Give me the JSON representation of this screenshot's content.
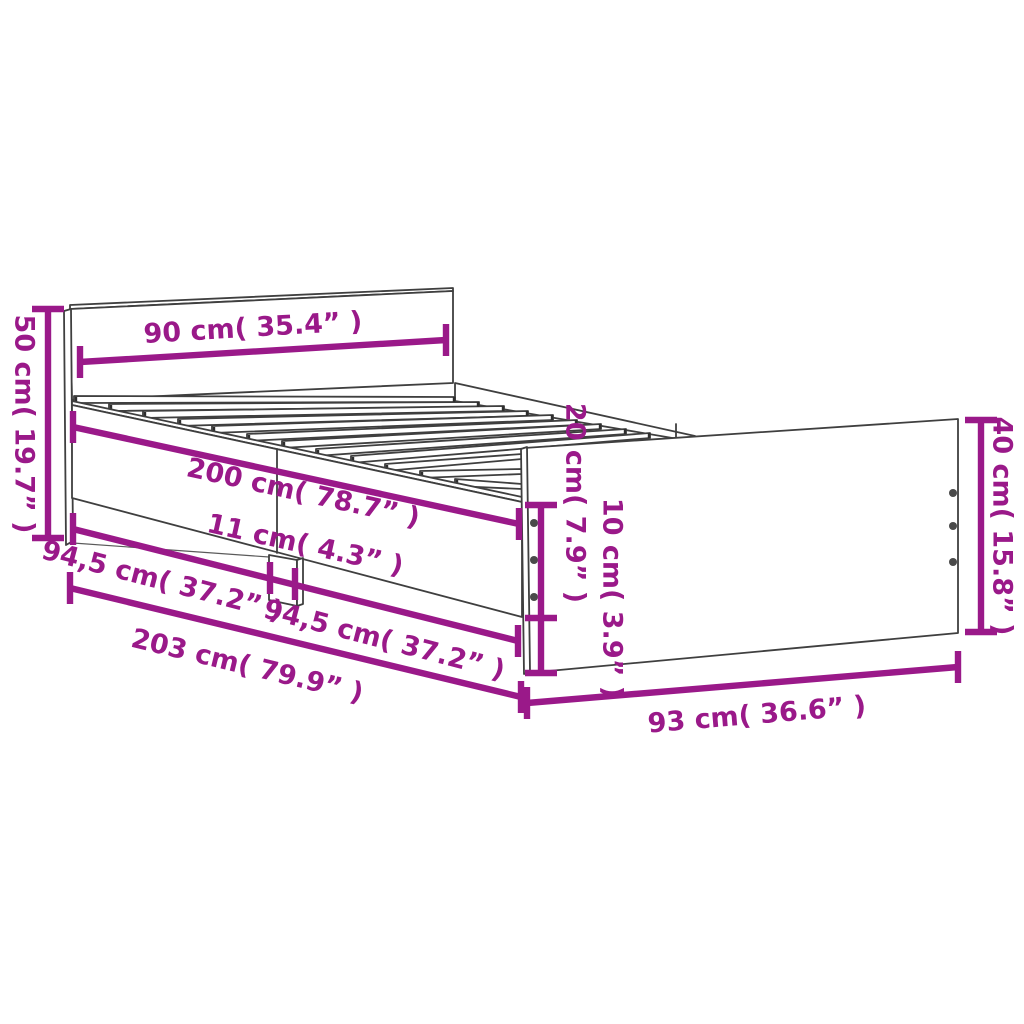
{
  "drawing": {
    "subject": "bed-frame-with-drawers-dimension-diagram",
    "accent_color": "#9A1989",
    "outline_color": "#3f3f3f",
    "slat_count": 12,
    "screw_dots_per_edge": 3
  },
  "dimensions": {
    "headboard_width": "90 cm( 35.4” )",
    "headboard_height": "50 cm( 19.7” )",
    "bed_length": "200 cm( 78.7” )",
    "center_support_width": "11 cm( 4.3” )",
    "left_span": "94,5 cm( 37.2” )",
    "right_span": "94,5 cm( 37.2” )",
    "total_length": "203 cm( 79.9” )",
    "rail_height": "20 cm( 7.9” )",
    "clearance": "10 cm( 3.9” )",
    "footboard_height": "40 cm( 15.8” )",
    "footboard_width": "93 cm( 36.6” )"
  }
}
